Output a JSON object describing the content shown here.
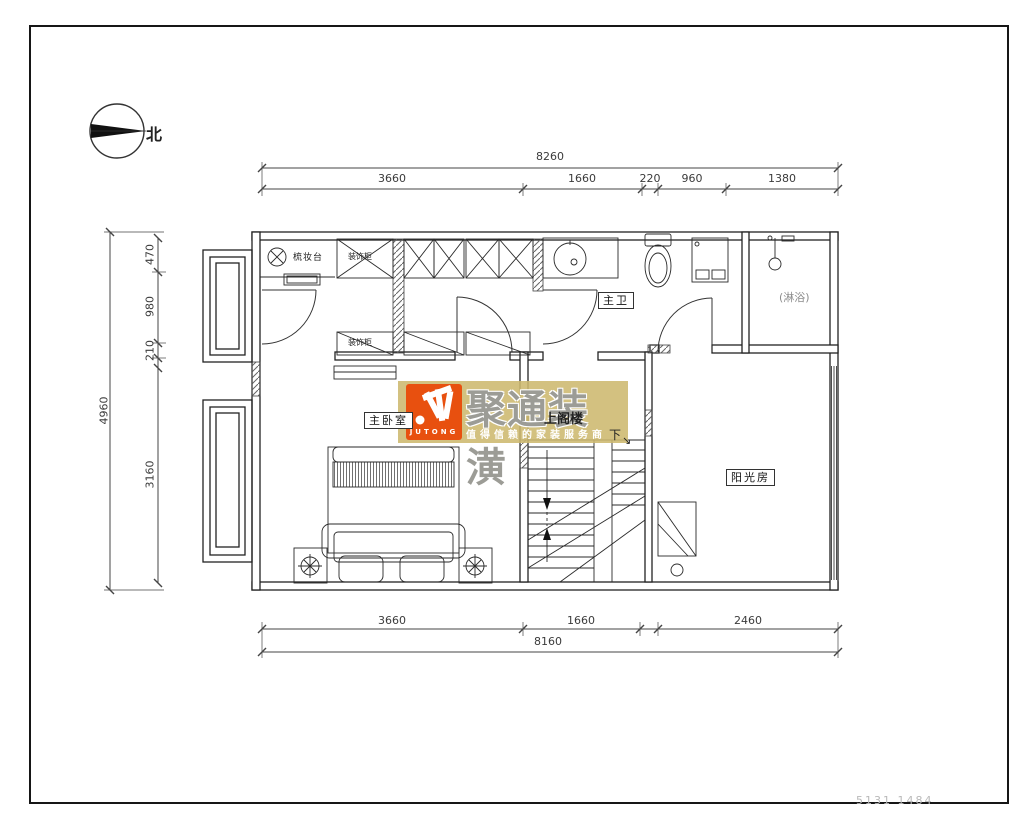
{
  "compass": {
    "north_label": "北"
  },
  "logo": {
    "brand": "聚通装潢",
    "brand_en": "JUTONG",
    "tagline": "值得信赖的家装服务商",
    "band_color": "#cdb86e",
    "square_color": "#e8500f"
  },
  "rooms": {
    "master_bath": "主卫",
    "master_bedroom": "主卧室",
    "sunroom": "阳光房",
    "shower": "(淋浴)",
    "attic_stairs": "上阁楼",
    "stairs_down": "下",
    "stairs_down_arrow": "↘",
    "dressing_table": "梳妆台",
    "cabinet_top": "装饰柜",
    "cabinet_bottom": "装饰柜"
  },
  "dimensions": {
    "top": {
      "overall": "8260",
      "segments": [
        "3660",
        "1660",
        "220",
        "960",
        "1380"
      ]
    },
    "bottom": {
      "overall": "8160",
      "segments": [
        "3660",
        "1660",
        "2460"
      ]
    },
    "left": {
      "overall": "4960",
      "segments": [
        "470",
        "980",
        "210",
        "3160"
      ]
    }
  },
  "watermark": "5131 1484"
}
